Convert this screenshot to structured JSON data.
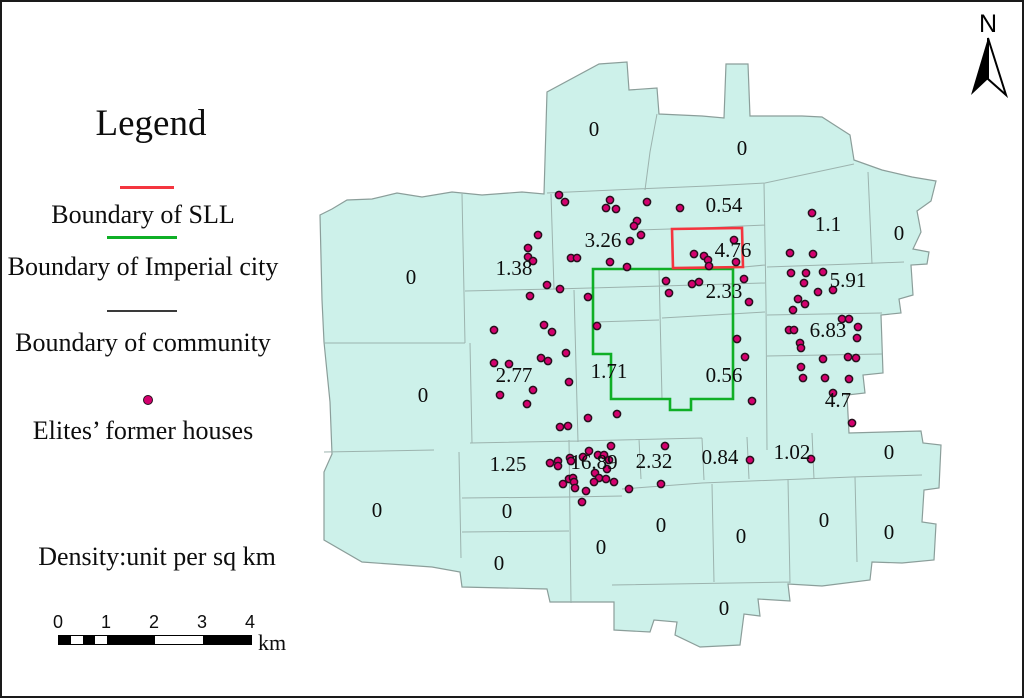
{
  "legend": {
    "title": "Legend",
    "items": [
      {
        "label": "Boundary of SLL",
        "swatch": "line",
        "color": "#f4353f"
      },
      {
        "label": "Boundary of Imperial city",
        "swatch": "line",
        "color": "#0faf26"
      },
      {
        "label": "Boundary of community",
        "swatch": "line",
        "color": "#3a3a3a"
      },
      {
        "label": "Elites’ former houses",
        "swatch": "dot",
        "color": "#d4006e"
      }
    ],
    "density_note": "Density:unit per sq km"
  },
  "scale_bar": {
    "ticks": [
      "0",
      "1",
      "2",
      "3",
      "4"
    ],
    "unit": "km"
  },
  "north_arrow": {
    "label": "N"
  },
  "map": {
    "fill": "#cdf1ea",
    "community_line_color": "#9cb3ae",
    "outline_color": "#8b9e9a",
    "sll_color": "#f4353f",
    "imperial_color": "#0faf26",
    "dot_fill": "#d4006e",
    "dot_stroke": "#26101c",
    "density_labels": [
      {
        "value": "0",
        "x": 592,
        "y": 129
      },
      {
        "value": "0",
        "x": 740,
        "y": 148
      },
      {
        "value": "0.54",
        "x": 722,
        "y": 205
      },
      {
        "value": "1.1",
        "x": 826,
        "y": 224
      },
      {
        "value": "0",
        "x": 897,
        "y": 233
      },
      {
        "value": "3.26",
        "x": 601,
        "y": 240
      },
      {
        "value": "4.76",
        "x": 731,
        "y": 250
      },
      {
        "value": "1.38",
        "x": 512,
        "y": 268
      },
      {
        "value": "0",
        "x": 409,
        "y": 277
      },
      {
        "value": "5.91",
        "x": 846,
        "y": 280
      },
      {
        "value": "2.33",
        "x": 722,
        "y": 291
      },
      {
        "value": "6.83",
        "x": 826,
        "y": 330
      },
      {
        "value": "2.77",
        "x": 512,
        "y": 375
      },
      {
        "value": "1.71",
        "x": 607,
        "y": 371
      },
      {
        "value": "0.56",
        "x": 722,
        "y": 375
      },
      {
        "value": "0",
        "x": 421,
        "y": 395
      },
      {
        "value": "4.7",
        "x": 836,
        "y": 400
      },
      {
        "value": "1.25",
        "x": 506,
        "y": 464
      },
      {
        "value": "16.89",
        "x": 592,
        "y": 462
      },
      {
        "value": "2.32",
        "x": 652,
        "y": 461
      },
      {
        "value": "0.84",
        "x": 718,
        "y": 457
      },
      {
        "value": "1.02",
        "x": 790,
        "y": 452
      },
      {
        "value": "0",
        "x": 887,
        "y": 452
      },
      {
        "value": "0",
        "x": 375,
        "y": 510
      },
      {
        "value": "0",
        "x": 505,
        "y": 511
      },
      {
        "value": "0",
        "x": 822,
        "y": 520
      },
      {
        "value": "0",
        "x": 659,
        "y": 525
      },
      {
        "value": "0",
        "x": 887,
        "y": 532
      },
      {
        "value": "0",
        "x": 739,
        "y": 536
      },
      {
        "value": "0",
        "x": 599,
        "y": 547
      },
      {
        "value": "0",
        "x": 497,
        "y": 563
      },
      {
        "value": "0",
        "x": 722,
        "y": 608
      }
    ],
    "houses": [
      [
        557,
        193
      ],
      [
        563,
        200
      ],
      [
        608,
        198
      ],
      [
        604,
        206
      ],
      [
        614,
        207
      ],
      [
        645,
        200
      ],
      [
        678,
        206
      ],
      [
        635,
        219
      ],
      [
        632,
        224
      ],
      [
        639,
        233
      ],
      [
        628,
        239
      ],
      [
        536,
        233
      ],
      [
        526,
        246
      ],
      [
        526,
        255
      ],
      [
        531,
        259
      ],
      [
        569,
        256
      ],
      [
        575,
        256
      ],
      [
        608,
        260
      ],
      [
        625,
        265
      ],
      [
        545,
        283
      ],
      [
        558,
        287
      ],
      [
        528,
        294
      ],
      [
        586,
        295
      ],
      [
        595,
        324
      ],
      [
        492,
        328
      ],
      [
        542,
        323
      ],
      [
        550,
        330
      ],
      [
        692,
        252
      ],
      [
        702,
        254
      ],
      [
        706,
        258
      ],
      [
        707,
        264
      ],
      [
        732,
        238
      ],
      [
        734,
        260
      ],
      [
        664,
        279
      ],
      [
        667,
        291
      ],
      [
        690,
        282
      ],
      [
        697,
        280
      ],
      [
        742,
        277
      ],
      [
        747,
        300
      ],
      [
        735,
        337
      ],
      [
        743,
        355
      ],
      [
        564,
        351
      ],
      [
        539,
        356
      ],
      [
        546,
        359
      ],
      [
        492,
        361
      ],
      [
        507,
        362
      ],
      [
        567,
        380
      ],
      [
        531,
        388
      ],
      [
        498,
        393
      ],
      [
        525,
        402
      ],
      [
        586,
        416
      ],
      [
        615,
        412
      ],
      [
        750,
        399
      ],
      [
        558,
        425
      ],
      [
        566,
        424
      ],
      [
        587,
        449
      ],
      [
        609,
        444
      ],
      [
        663,
        444
      ],
      [
        548,
        461
      ],
      [
        556,
        459
      ],
      [
        556,
        464
      ],
      [
        568,
        456
      ],
      [
        569,
        459
      ],
      [
        581,
        455
      ],
      [
        596,
        453
      ],
      [
        602,
        453
      ],
      [
        607,
        458
      ],
      [
        605,
        467
      ],
      [
        593,
        471
      ],
      [
        597,
        476
      ],
      [
        592,
        480
      ],
      [
        561,
        482
      ],
      [
        567,
        477
      ],
      [
        571,
        476
      ],
      [
        572,
        480
      ],
      [
        573,
        486
      ],
      [
        584,
        489
      ],
      [
        604,
        477
      ],
      [
        612,
        480
      ],
      [
        627,
        487
      ],
      [
        659,
        482
      ],
      [
        580,
        500
      ],
      [
        748,
        458
      ],
      [
        809,
        457
      ],
      [
        810,
        211
      ],
      [
        788,
        251
      ],
      [
        811,
        252
      ],
      [
        789,
        271
      ],
      [
        804,
        271
      ],
      [
        821,
        270
      ],
      [
        802,
        281
      ],
      [
        816,
        290
      ],
      [
        831,
        288
      ],
      [
        796,
        297
      ],
      [
        803,
        302
      ],
      [
        791,
        308
      ],
      [
        840,
        317
      ],
      [
        847,
        317
      ],
      [
        787,
        328
      ],
      [
        792,
        328
      ],
      [
        856,
        325
      ],
      [
        855,
        336
      ],
      [
        798,
        341
      ],
      [
        799,
        346
      ],
      [
        821,
        357
      ],
      [
        846,
        355
      ],
      [
        854,
        356
      ],
      [
        799,
        365
      ],
      [
        801,
        376
      ],
      [
        823,
        376
      ],
      [
        847,
        377
      ],
      [
        831,
        391
      ],
      [
        850,
        421
      ]
    ]
  }
}
